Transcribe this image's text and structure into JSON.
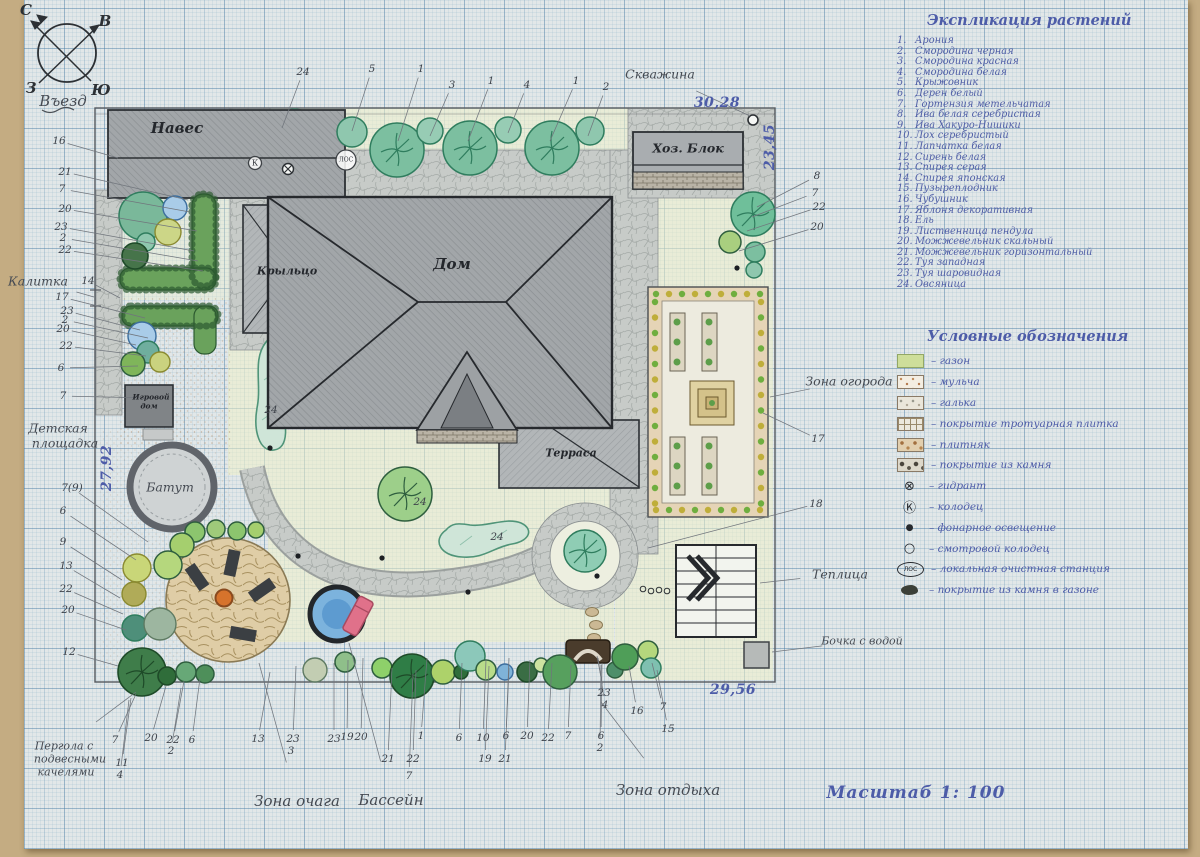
{
  "scale_label": "Масштаб 1: 100",
  "plant_list": {
    "title": "Экспликация растений",
    "items": [
      "Арония",
      "Смородина черная",
      "Смородина красная",
      "Смородина белая",
      "Крыжовник",
      "Дерен белый",
      "Гортензия метельчатая",
      "Ива белая серебристая",
      "Ива Хакуро-Нишики",
      "Лох серебристый",
      "Лапчатка белая",
      "Сирень белая",
      "Спирея серая",
      "Спирея японская",
      "Пузыреплодник",
      "Чубушник",
      "Яблоня декоративная",
      "Ель",
      "Лиственница пендула",
      "Можжевельник скальный",
      "Можжевельник горизонтальный",
      "Туя западная",
      "Туя шаровидная",
      "Овсяница"
    ]
  },
  "legend": {
    "title": "Условные обозначения",
    "items": [
      {
        "icon": "lawn",
        "label": "газон"
      },
      {
        "icon": "mulch",
        "label": "мульча"
      },
      {
        "icon": "pebble",
        "label": "галька"
      },
      {
        "icon": "grid",
        "label": "покрытие тротуарная плитка"
      },
      {
        "icon": "flag",
        "label": "плитняк"
      },
      {
        "icon": "stone",
        "label": "покрытие из камня"
      },
      {
        "icon": "hydrant",
        "label": "гидрант",
        "icon_text": "⊗"
      },
      {
        "icon": "well",
        "label": "колодец",
        "icon_text": "Ⓚ"
      },
      {
        "icon": "lamp",
        "label": "фонарное освещение",
        "icon_text": "●"
      },
      {
        "icon": "manhole",
        "label": "смотровой колодец",
        "icon_text": "○"
      },
      {
        "icon": "los",
        "label": "локальная очистная станция",
        "icon_text": "ЛОС"
      },
      {
        "icon": "blob",
        "label": "покрытие из камня в газоне"
      }
    ]
  },
  "plan_labels": [
    {
      "text": "С",
      "x": 26,
      "y": 10,
      "cls": "lbl-compass"
    },
    {
      "text": "В",
      "x": 105,
      "y": 21,
      "cls": "lbl-compass"
    },
    {
      "text": "З",
      "x": 31,
      "y": 88,
      "cls": "lbl-compass"
    },
    {
      "text": "Ю",
      "x": 101,
      "y": 90,
      "cls": "lbl-compass"
    },
    {
      "text": "Въезд",
      "x": 63,
      "y": 101,
      "cls": "lbl-lg"
    },
    {
      "text": "Навес",
      "x": 177,
      "y": 128,
      "cls": "lbl-lg dark"
    },
    {
      "text": "Скважина",
      "x": 660,
      "y": 74,
      "cls": "lbl",
      "lx": 750,
      "ly": 116
    },
    {
      "text": "Хоз. Блок",
      "x": 688,
      "y": 148,
      "cls": "lbl dark"
    },
    {
      "text": "Дом",
      "x": 452,
      "y": 264,
      "cls": "lbl-lg dark"
    },
    {
      "text": "Крыльцо",
      "x": 287,
      "y": 271,
      "cls": "lbl-sm dark"
    },
    {
      "text": "Терраса",
      "x": 571,
      "y": 453,
      "cls": "lbl-sm dark"
    },
    {
      "text": "Калитка",
      "x": 38,
      "y": 281,
      "cls": "lbl",
      "lx": 94,
      "ly": 297
    },
    {
      "text": "Игровой",
      "x": 151,
      "y": 397,
      "cls": "lbl-xs dark"
    },
    {
      "text": "дом",
      "x": 149,
      "y": 406,
      "cls": "lbl-xs dark"
    },
    {
      "text": "Батут",
      "x": 170,
      "y": 487,
      "cls": "lbl"
    },
    {
      "text": "Детская",
      "x": 58,
      "y": 428,
      "cls": "lbl"
    },
    {
      "text": "площадка",
      "x": 65,
      "y": 443,
      "cls": "lbl"
    },
    {
      "text": "Зона огорода",
      "x": 849,
      "y": 381,
      "cls": "lbl",
      "lx": 770,
      "ly": 397
    },
    {
      "text": "Теплица",
      "x": 840,
      "y": 574,
      "cls": "lbl",
      "lx": 760,
      "ly": 583
    },
    {
      "text": "Бочка с водой",
      "x": 862,
      "y": 641,
      "cls": "lbl-sm",
      "lx": 772,
      "ly": 652
    },
    {
      "text": "Зона отдыха",
      "x": 668,
      "y": 790,
      "cls": "lbl-lg",
      "lx": 601,
      "ly": 702
    },
    {
      "text": "Зона очага",
      "x": 297,
      "y": 801,
      "cls": "lbl-lg",
      "lx": 259,
      "ly": 663
    },
    {
      "text": "Бассейн",
      "x": 391,
      "y": 800,
      "cls": "lbl-lg",
      "lx": 349,
      "ly": 643
    },
    {
      "text": "Пергола с",
      "x": 64,
      "y": 746,
      "cls": "lbl-sm",
      "lx": 136,
      "ly": 692
    },
    {
      "text": "подвесными",
      "x": 70,
      "y": 759,
      "cls": "lbl-sm"
    },
    {
      "text": "качелями",
      "x": 66,
      "y": 772,
      "cls": "lbl-sm"
    },
    {
      "text": "ЛОС",
      "x": 346,
      "y": 160,
      "cls": "lbl-los"
    },
    {
      "text": "К",
      "x": 255,
      "y": 163,
      "cls": "lbl-k"
    },
    {
      "text": "30,28",
      "x": 717,
      "y": 103,
      "cls": "dim"
    },
    {
      "text": "29,56",
      "x": 733,
      "y": 690,
      "cls": "dim"
    },
    {
      "text": "27,92",
      "x": 107,
      "y": 468,
      "cls": "dim vdim"
    },
    {
      "text": "23,45",
      "x": 770,
      "y": 147,
      "cls": "dim vdim"
    },
    {
      "text": "Масштаб 1: 100",
      "x": 916,
      "y": 793,
      "cls": "ink-scale"
    }
  ],
  "annotations": [
    {
      "t": "24",
      "x": 303,
      "y": 72,
      "lx": 282,
      "ly": 128
    },
    {
      "t": "5",
      "x": 372,
      "y": 69,
      "lx": 352,
      "ly": 131
    },
    {
      "t": "1",
      "x": 421,
      "y": 69,
      "lx": 398,
      "ly": 141
    },
    {
      "t": "3",
      "x": 452,
      "y": 85,
      "lx": 430,
      "ly": 136
    },
    {
      "t": "1",
      "x": 491,
      "y": 81,
      "lx": 468,
      "ly": 141
    },
    {
      "t": "4",
      "x": 527,
      "y": 85,
      "lx": 508,
      "ly": 133
    },
    {
      "t": "1",
      "x": 576,
      "y": 81,
      "lx": 550,
      "ly": 141
    },
    {
      "t": "2",
      "x": 606,
      "y": 87,
      "lx": 588,
      "ly": 136
    },
    {
      "t": "8",
      "x": 817,
      "y": 176,
      "lx": 757,
      "ly": 207
    },
    {
      "t": "7",
      "x": 815,
      "y": 193,
      "lx": 752,
      "ly": 217
    },
    {
      "t": "22",
      "x": 819,
      "y": 207,
      "lx": 747,
      "ly": 231
    },
    {
      "t": "20",
      "x": 817,
      "y": 227,
      "lx": 739,
      "ly": 251
    },
    {
      "t": "17",
      "x": 818,
      "y": 439,
      "lx": 763,
      "ly": 413
    },
    {
      "t": "18",
      "x": 816,
      "y": 504,
      "lx": 648,
      "ly": 548
    },
    {
      "t": "16",
      "x": 59,
      "y": 141,
      "lx": 118,
      "ly": 158
    },
    {
      "t": "21",
      "x": 65,
      "y": 172,
      "lx": 188,
      "ly": 200
    },
    {
      "t": "7",
      "x": 62,
      "y": 189,
      "lx": 190,
      "ly": 212
    },
    {
      "t": "20",
      "x": 65,
      "y": 209,
      "lx": 197,
      "ly": 231
    },
    {
      "t": "23",
      "x": 61,
      "y": 227,
      "lx": 194,
      "ly": 251
    },
    {
      "t": "2",
      "x": 63,
      "y": 238,
      "lx": 198,
      "ly": 261
    },
    {
      "t": "22",
      "x": 65,
      "y": 250,
      "lx": 203,
      "ly": 271
    },
    {
      "t": "14",
      "x": 88,
      "y": 281,
      "lx": 120,
      "ly": 298
    },
    {
      "t": "17",
      "x": 62,
      "y": 297,
      "lx": 145,
      "ly": 318
    },
    {
      "t": "23",
      "x": 67,
      "y": 311,
      "lx": 140,
      "ly": 330
    },
    {
      "t": "2",
      "x": 65,
      "y": 320,
      "lx": 148,
      "ly": 338
    },
    {
      "t": "20",
      "x": 63,
      "y": 329,
      "lx": 136,
      "ly": 345
    },
    {
      "t": "22",
      "x": 66,
      "y": 346,
      "lx": 146,
      "ly": 356
    },
    {
      "t": "6",
      "x": 61,
      "y": 368,
      "lx": 138,
      "ly": 366
    },
    {
      "t": "7",
      "x": 63,
      "y": 396,
      "lx": 148,
      "ly": 398
    },
    {
      "t": "7(9)",
      "x": 72,
      "y": 488,
      "lx": 148,
      "ly": 542
    },
    {
      "t": "6",
      "x": 63,
      "y": 511,
      "lx": 136,
      "ly": 560
    },
    {
      "t": "9",
      "x": 63,
      "y": 542,
      "lx": 122,
      "ly": 580
    },
    {
      "t": "13",
      "x": 66,
      "y": 566,
      "lx": 120,
      "ly": 598
    },
    {
      "t": "22",
      "x": 66,
      "y": 589,
      "lx": 123,
      "ly": 614
    },
    {
      "t": "20",
      "x": 68,
      "y": 610,
      "lx": 126,
      "ly": 630
    },
    {
      "t": "12",
      "x": 69,
      "y": 652,
      "lx": 118,
      "ly": 666
    },
    {
      "t": "7",
      "x": 115,
      "y": 740,
      "lx": 136,
      "ly": 694
    },
    {
      "t": "20",
      "x": 151,
      "y": 738,
      "lx": 166,
      "ly": 686
    },
    {
      "t": "22",
      "x": 173,
      "y": 740,
      "lx": 184,
      "ly": 681
    },
    {
      "t": "6",
      "x": 192,
      "y": 740,
      "lx": 200,
      "ly": 678
    },
    {
      "t": "2",
      "x": 171,
      "y": 751,
      "lx": 181,
      "ly": 688
    },
    {
      "t": "11",
      "x": 122,
      "y": 763,
      "lx": 131,
      "ly": 698
    },
    {
      "t": "4",
      "x": 120,
      "y": 775,
      "lx": 129,
      "ly": 700
    },
    {
      "t": "13",
      "x": 258,
      "y": 739,
      "lx": 270,
      "ly": 672
    },
    {
      "t": "23",
      "x": 293,
      "y": 739,
      "lx": 296,
      "ly": 666
    },
    {
      "t": "3",
      "x": 291,
      "y": 751
    },
    {
      "t": "23",
      "x": 334,
      "y": 739,
      "lx": 334,
      "ly": 663
    },
    {
      "t": "19",
      "x": 347,
      "y": 737,
      "lx": 348,
      "ly": 660
    },
    {
      "t": "20",
      "x": 361,
      "y": 737,
      "lx": 363,
      "ly": 658
    },
    {
      "t": "21",
      "x": 388,
      "y": 759,
      "lx": 392,
      "ly": 668
    },
    {
      "t": "22",
      "x": 413,
      "y": 759,
      "lx": 416,
      "ly": 670
    },
    {
      "t": "7",
      "x": 409,
      "y": 776,
      "lx": 413,
      "ly": 674
    },
    {
      "t": "1",
      "x": 421,
      "y": 736,
      "lx": 427,
      "ly": 658
    },
    {
      "t": "6",
      "x": 459,
      "y": 738,
      "lx": 462,
      "ly": 663
    },
    {
      "t": "10",
      "x": 483,
      "y": 738,
      "lx": 486,
      "ly": 660
    },
    {
      "t": "6",
      "x": 506,
      "y": 736,
      "lx": 509,
      "ly": 658
    },
    {
      "t": "20",
      "x": 527,
      "y": 736,
      "lx": 530,
      "ly": 660
    },
    {
      "t": "22",
      "x": 548,
      "y": 738,
      "lx": 552,
      "ly": 663
    },
    {
      "t": "7",
      "x": 568,
      "y": 736,
      "lx": 571,
      "ly": 665
    },
    {
      "t": "19",
      "x": 485,
      "y": 759,
      "lx": 489,
      "ly": 666
    },
    {
      "t": "21",
      "x": 505,
      "y": 759,
      "lx": 509,
      "ly": 668
    },
    {
      "t": "6",
      "x": 601,
      "y": 736,
      "lx": 602,
      "ly": 663
    },
    {
      "t": "2",
      "x": 600,
      "y": 748,
      "lx": 601,
      "ly": 665
    },
    {
      "t": "23",
      "x": 604,
      "y": 693,
      "lx": 597,
      "ly": 656
    },
    {
      "t": "4",
      "x": 605,
      "y": 705,
      "lx": 598,
      "ly": 658
    },
    {
      "t": "16",
      "x": 637,
      "y": 711,
      "lx": 629,
      "ly": 666
    },
    {
      "t": "7",
      "x": 663,
      "y": 707,
      "lx": 652,
      "ly": 663
    },
    {
      "t": "15",
      "x": 668,
      "y": 729,
      "lx": 657,
      "ly": 670
    },
    {
      "t": "24",
      "x": 271,
      "y": 410
    },
    {
      "t": "24",
      "x": 497,
      "y": 537
    },
    {
      "t": "24",
      "x": 420,
      "y": 502
    }
  ]
}
